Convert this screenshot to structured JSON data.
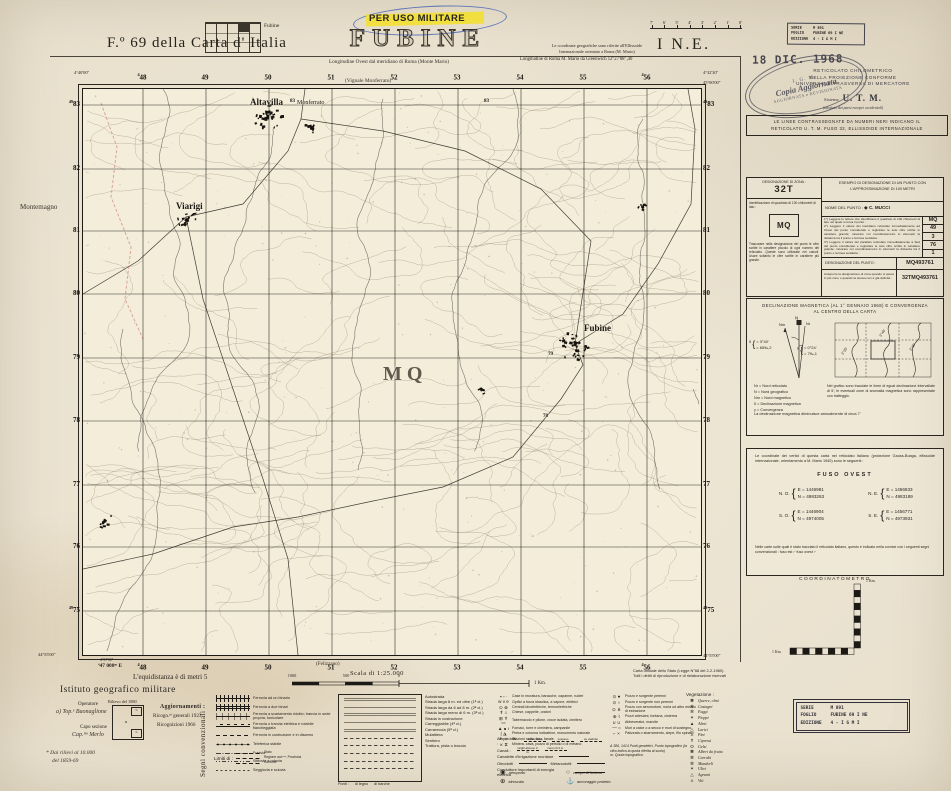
{
  "colors": {
    "paper": "#ebe3d0",
    "ink": "#2b2520",
    "map_bg": "#f3edda",
    "highlight_yellow": "#f2df34",
    "pen_blue": "#3a5cb4",
    "stamp_gray": "#47464e",
    "boundary_red": "#c4686a"
  },
  "index_block": {
    "icon_label": "Fubine",
    "title": "F.º 69 della Carta d' Italia"
  },
  "header": {
    "military_use": "PER USO MILITARE",
    "title": "FUBINE",
    "lon_note": "Longitudine Ovest dal meridiano di Roma (Monte Mario)",
    "coord_note_1": "Le coordinate geografiche sono riferite all'Ellissoide",
    "coord_note_2": "Internazionale orientato a Roma (M. Mario)",
    "coord_note_3": "Longitudine di Roma M. Mario da Greenwich 12°27'08″,40",
    "quadrant": "I N.E.",
    "minute_labels": [
      "7'",
      "6'",
      "5'",
      "4'",
      "3'",
      "2'",
      "1'",
      "0'"
    ]
  },
  "stamps": {
    "serie": {
      "l1": "SERIE",
      "v1": "M 891",
      "l2": "FOGLIO",
      "v2": "FUBINE 69 I NE",
      "l3": "EDIZIONE",
      "v3": "4   - I G M I"
    },
    "date": "18 DIC. 1968",
    "utm_lines": [
      "RETICOLATO  CHILOMETRICO",
      "NELLA  PROIEZIONE  CONFORME",
      "UNIVERSALE  TRASVERSA  DI  MERCATORE"
    ],
    "utm_sys": "Sistema",
    "utm_big": "U. T. M.",
    "utm_sub": "(adottato dai paesi europei occidentali)",
    "oval": {
      "l1": "I. G. M.",
      "l2": "Copia Aggiornata",
      "l3": "AGGIORNATA e REVISIONATA"
    },
    "grid_note_1": "LE LINEE CONTRASSEGNATE DA NUMERI NERI INDICANO IL",
    "grid_note_2": "RETICOLATO U. T. M. FUSO 32, ELLISSOIDE INTERNAZIONALE"
  },
  "designation": {
    "zone_label": "DESIGNAZIONE DI ZONA :",
    "zone": "32T",
    "square_label": "Identificazione di quadrato di 100 chilometri di lato :",
    "square": "MQ",
    "small_note": "Trascurare nella designazione del punto le cifre scritte in carattere piccolo di ogni numero del reticolato. Queste sono utilizzate nei calcoli. Usare soltanto le cifre scritte in carattere più grande.",
    "example_title": "ESEMPIO DI DESIGNAZIONE DI UN PUNTO CON L'APPROSSIMAZIONE DI 100 METRI",
    "name_label": "NOME DEL PUNTO :",
    "name": "◆ C. MUCCI",
    "steps": [
      {
        "text": "1°) Leggere le lettere che identificano il quadrato di 100 chilometri di lato nel quale si trova il punto :",
        "v1": "MQ"
      },
      {
        "text": "2°) Leggere il valore del meridiano reticolato immediatamente ad Ovest del punto considerato e registrare le sole cifre scritte in carattere grande; misurare col coordinatometro in ettometri la distanza tra il punto e la linea suddetta :",
        "v1": "49",
        "v2": "3"
      },
      {
        "text": "3°) Leggere il valore del parallelo reticolato immediatamente a Sud del punto considerato e registrare le sole cifre scritte in carattere grande; misurare col coordinatometro in ettometri la distanza tra il punto e la linea suddetta :",
        "v1": "76",
        "v2": "1"
      }
    ],
    "result_label": "DESIGNAZIONE DEL PUNTO :",
    "result": "MQ493761",
    "zone_note": "Anteporre la designazione di zona quando si opera in più zone o quando la stessa non è già definita :",
    "full_result": "32TMQ493761"
  },
  "declination": {
    "title_1": "DECLINAZIONE MAGNETICA (AL 1° GENNAIO 1968) E CONVERGENZA",
    "title_2": "AL CENTRO DELLA CARTA",
    "n": "N",
    "nr": "Nr",
    "nm": "Nm",
    "delta": {
      "sym": "δ",
      "deg": "=  3°40'",
      "mils": "=  65‰,2"
    },
    "gamma": {
      "sym": "γ",
      "deg": "=  0°24'",
      "mils": "=  7‰,1"
    },
    "iso_labels": [
      "3°35'",
      "3°40'",
      "3°45'"
    ],
    "legend": [
      "Nr  =  Nord reticolato",
      "N   =  Nord geografico",
      "Nm =  Nord magnetico",
      "δ    =  Declinazione magnetica",
      "γ    =  Convergenza"
    ],
    "iso_note": "Nel grafico sono tracciate le linee di egual declinazione intervallate di 5'; le eventuali zone di anomalia magnetica sono rappresentate con tratteggio.",
    "annual_note": "La declinazione magnetica diminuisce annualmente di circa 7'"
  },
  "fuso": {
    "intro": "Le coordinate dei vertici di questa carta nel reticolato italiano (proiezione Gauss-Boaga, ellissoide internazionale, orientamento a M. Mario 1940) sono le seguenti :",
    "title": "FUSO OVEST",
    "corners": [
      {
        "label": "N. O.",
        "e": "E  =  1446981",
        "n": "N  =  4983263"
      },
      {
        "label": "N. E.",
        "e": "E  =  1456833",
        "n": "N  =  4983189"
      },
      {
        "label": "S. O.",
        "e": "E  =  1446904",
        "n": "N  =  4974005"
      },
      {
        "label": "S. E.",
        "e": "E  =  1456771",
        "n": "N  =  4973931"
      }
    ],
    "note": "Nelle carte sulle quali è stato tracciato il reticolato italiano, questo è indicato nella cornice con i seguenti segni convenzionali :   fuso est ⌐     fuso ovest ⌐"
  },
  "coordinatometro": {
    "title": "COORDINATOMETRO",
    "km_v": "1 Km.",
    "km_h": "1 Km."
  },
  "margins": {
    "adjoining_top": "(Vignale Monferrato)",
    "adjoining_left": "Montemagno",
    "adjoining_bottom": "(Felizzano)",
    "top_numbers": [
      {
        "pre": "4",
        "t": "48",
        "x": 142
      },
      {
        "t": "49",
        "x": 205
      },
      {
        "t": "50",
        "x": 268
      },
      {
        "t": "51",
        "x": 331
      },
      {
        "t": "52",
        "x": 394
      },
      {
        "t": "53",
        "x": 457
      },
      {
        "t": "54",
        "x": 520
      },
      {
        "t": "55",
        "x": 583
      },
      {
        "pre": "4",
        "t": "56",
        "x": 646
      }
    ],
    "bottom_numbers": [
      {
        "pre": "4",
        "t": "48",
        "x": 142
      },
      {
        "t": "49",
        "x": 205
      },
      {
        "t": "50",
        "x": 268
      },
      {
        "t": "51",
        "x": 331
      },
      {
        "t": "52",
        "x": 394
      },
      {
        "t": "53",
        "x": 457
      },
      {
        "t": "54",
        "x": 520
      },
      {
        "t": "55",
        "x": 583
      },
      {
        "pre": "4",
        "t": "56",
        "x": 646
      }
    ],
    "left_numbers": [
      {
        "pre": "49",
        "t": "83",
        "y": 104
      },
      {
        "t": "82",
        "y": 168
      },
      {
        "t": "81",
        "y": 230
      },
      {
        "t": "80",
        "y": 293
      },
      {
        "t": "79",
        "y": 357
      },
      {
        "t": "78",
        "y": 420
      },
      {
        "t": "77",
        "y": 484
      },
      {
        "t": "76",
        "y": 546
      },
      {
        "pre": "49",
        "t": "75",
        "y": 610
      }
    ],
    "right_numbers": [
      {
        "pre": "49",
        "t": "83",
        "y": 104
      },
      {
        "t": "82",
        "y": 168
      },
      {
        "t": "81",
        "y": 230
      },
      {
        "t": "80",
        "y": 293
      },
      {
        "t": "79",
        "y": 357
      },
      {
        "t": "78",
        "y": 420
      },
      {
        "t": "77",
        "y": 484
      },
      {
        "t": "76",
        "y": 546
      },
      {
        "pre": "49",
        "t": "75",
        "y": 610
      }
    ],
    "corner_tl": "4°40'00″",
    "corner_tr_lon": "4°32'30″",
    "corner_tr_lat": "45°00'00″",
    "corner_bl_lat": "44°55'00″",
    "corner_bl_lon": "4°37'30″",
    "easting_origin": "⁴47 000ᵐ E",
    "corner_br_lat": "44°55'00″"
  },
  "map_labels": [
    {
      "t": "Altavilla",
      "x": 250,
      "y": 97,
      "cls": "town"
    },
    {
      "t": "Monferrato",
      "x": 297,
      "y": 100,
      "cls": "town-sub"
    },
    {
      "t": "Viarigi",
      "x": 176,
      "y": 201,
      "cls": "town"
    },
    {
      "t": "Fubine",
      "x": 584,
      "y": 323,
      "cls": "town"
    },
    {
      "t": "MQ",
      "x": 383,
      "y": 363,
      "cls": "grid-letters"
    },
    {
      "t": "83",
      "x": 290,
      "y": 99,
      "cls": "grid-num"
    },
    {
      "t": "83",
      "x": 484,
      "y": 99,
      "cls": "grid-num"
    },
    {
      "t": "79",
      "x": 548,
      "y": 352,
      "cls": "grid-num"
    },
    {
      "t": "78",
      "x": 543,
      "y": 414,
      "cls": "grid-num"
    }
  ],
  "scale": {
    "adjoining": "(Felizzano)",
    "label": "Scala di 1:25.000",
    "ticks": [
      {
        "t": "1000",
        "x": 292
      },
      {
        "t": "500",
        "x": 346
      },
      {
        "t": "0",
        "x": 399
      }
    ],
    "end": "1 Km."
  },
  "credits": {
    "equidistance": "L'equidistanza è di metri 5",
    "igm": "Istituto geografico militare",
    "operator_label": "Operatore",
    "operator": "a) Top.ᵉ Buonaglione",
    "chief_label": "Capo sezione",
    "chief": "Cap.ᵐᵒ Merlo",
    "survey_label": "Rilievo del 1880",
    "survey_a": "a",
    "survey_b": "b",
    "footnote_1": "* Dai rilievi al 10.000",
    "footnote_2": "del 1859-69",
    "updates_label": "Aggiornamenti :",
    "update_1": "Ricogn.ⁿⁱ generali 1923",
    "update_2": "Ricognizioni 1966",
    "segni": "Segni convenzionali",
    "official_1": "Carta ufficiale dello Stato (Legge N°68 del 2-2-1960).",
    "official_2": "Tutti i diritti di riproduzione e di rielaborazione riservati"
  },
  "legend": {
    "railways": [
      "Ferrovia ad un binario",
      "Ferrovia a due binari",
      "Ferrovia a scartamento ridotto; tranvia in sede propria, funicolare",
      "Ferrovia o tranvia elettrica e rotabile fiancheggiata",
      "Ferrovia in costruzione e in disarmo",
      "Teleferica stabile",
      "Funivia",
      "Slittovia e rotovia",
      "Seggiovia e sciovia"
    ],
    "limits_label": "Limiti di :",
    "limits": [
      "Stato",
      "Regione aut.ᵐᵃ, Provincia",
      "Comune"
    ],
    "roads": [
      "Autostrada",
      "Strada larga 8 m. ed oltre (1ª cl.)",
      "Strada larga da 6 ad 8 m. (2ª cl.)",
      "Strada larga meno di 6 m. (3ª cl.)",
      "Strada in costruzione",
      "Carreggiabile (4ª cl.)",
      "Carrareccia (5ª cl.)",
      "Mulattiera",
      "Sentiero",
      "Trattura, pista o traccia"
    ],
    "bridges_label": "Ponti :",
    "bridges": [
      "di legno",
      "di barche"
    ],
    "buildings": [
      {
        "sym": "▪ ▫ ∙",
        "t": "Case in muratura, baracche, capanne, ruderi"
      },
      {
        "sym": "w v e",
        "t": "Opifici a forza idraulica, a vapore, elettrici"
      },
      {
        "sym": "⊙ ⊗",
        "t": "Centrali idroelettriche, termoelettriche"
      },
      {
        "sym": "✝ ⌂",
        "t": "Chiese, cappelle, oratori"
      },
      {
        "sym": "⊞ ✝ ▭",
        "t": "Tabernacolo e pilone, croce isolata, cimitero"
      },
      {
        "sym": "▲ ∎ ı",
        "t": "Fornaci, torre e ciminiera, campanile"
      },
      {
        "sym": "| ◮",
        "t": "Pietra e colonna indicatrice, monumento naturale"
      },
      {
        "sym": "✳ ☼",
        "t": "Stazioni radio, faro, fanale"
      },
      {
        "sym": "⨯ ⧖",
        "t": "Miniera, cava, pozzo di petrolio o di metano"
      }
    ],
    "wells": [
      {
        "sym": "⊙ ●",
        "t": "Pozzo e sorgente perenni"
      },
      {
        "sym": "⊙ ○",
        "t": "Pozzo e sorgente non perenni"
      },
      {
        "sym": "⊙ ⋔",
        "t": "Pozzo con aeromotore, noria od altro mezzo di estrazione"
      },
      {
        "sym": "⊕ ⌇",
        "t": "Pozzi artesiani, fontana, cisterna"
      },
      {
        "sym": "∪ ∪",
        "t": "Abbeveratoi, marcite"
      },
      {
        "sym": "— =",
        "t": "Muri a calce o a secco e muri di sostegno"
      },
      {
        "sym": "⌐ ×",
        "t": "Palizzata o sbarramento, siepe, filo spinato"
      }
    ],
    "wells_note_1": "Δ 386, 1414  Punti geodetici, Punto topografico (la cifra indica la quota riferita al suolo)",
    "wells_note_2": "m.  Quota topografica",
    "aqueducts_label": "Acquedotti :",
    "aqueduct_types": [
      "sotterraneo",
      "sospeso",
      "su viadotto"
    ],
    "canals_label": "Canali :",
    "canal_1": "larghi almeno 3 m.",
    "canal_2": "meno di 3 m.",
    "canal_3": "Canalette d'irrigazione montane",
    "pipe_1": "Oleodotti",
    "pipe_2": "Metanodotti",
    "power": "Condutture importanti di energia elettrica",
    "airports": [
      {
        "sym": "◉",
        "t": "aeroporto"
      },
      {
        "sym": "○",
        "t": "campo di fortuna"
      },
      {
        "sym": "⊕",
        "t": "idroscalo"
      },
      {
        "sym": "⚓",
        "t": "ancoraggio protetto"
      }
    ],
    "vegetation_label": "Vegetazione :",
    "vegetation": [
      {
        "sym": "✽",
        "t": "Querce, olmi"
      },
      {
        "sym": "✻",
        "t": "Castagni"
      },
      {
        "sym": "✼",
        "t": "Faggi"
      },
      {
        "sym": "✶",
        "t": "Pioppi"
      },
      {
        "sym": "▲",
        "t": "Abeti"
      },
      {
        "sym": "△",
        "t": "Larici"
      },
      {
        "sym": "⋏",
        "t": "Pini"
      },
      {
        "sym": "✝",
        "t": "Cipressi"
      },
      {
        "sym": "ʘ",
        "t": "Gelsi"
      },
      {
        "sym": "✽",
        "t": "Alberi da frutto"
      },
      {
        "sym": "✻",
        "t": "Carrubi"
      },
      {
        "sym": "✼",
        "t": "Mandorli"
      },
      {
        "sym": "✶",
        "t": "Ulivi"
      },
      {
        "sym": "△",
        "t": "Agrumi"
      },
      {
        "sym": "⋏",
        "t": "Viti"
      }
    ]
  }
}
